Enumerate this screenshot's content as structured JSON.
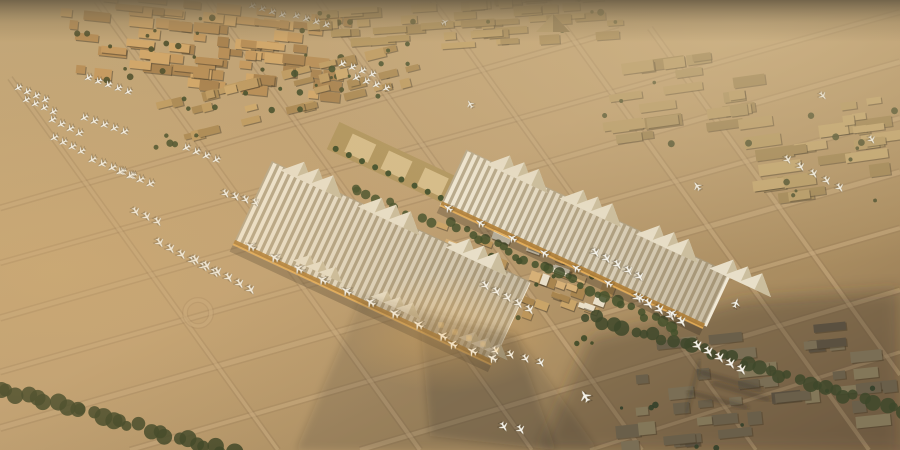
{
  "meta": {
    "title": "Aerial rendering of a desert mega-airport at golden hour",
    "description": "Computer-generated aerial view: striped white terminal canopies with triangular peaks, a low-rise medina-style core, taxiway grids with rows of parked aircraft, warehouse districts on the horizon, tree lines and long evening shadows over sand."
  },
  "palette": {
    "sand_light": "#c8ab7c",
    "sand_mid": "#b99a6c",
    "sand_dark": "#8a7253",
    "horizon": "#6f6148",
    "haze": "#d6bf93",
    "taxiway_light": "#d2b486",
    "taxiway_dark": "#8a7050",
    "canopy_stripe": "#f1e9d6",
    "canopy_base": "#b7a98c",
    "facade_gold": "#c28a3e",
    "glow": "#f2b761",
    "building_tan": "#c59a60",
    "building_shadowed": "#6a5f4a",
    "vegetation": "#44512c",
    "aircraft": "#f4f2ea",
    "shadow": "#322c21"
  },
  "scene": {
    "taxiway_lines": [
      {
        "x1": 0,
        "y1": 208,
        "x2": 620,
        "y2": 30,
        "w": 4
      },
      {
        "x1": 0,
        "y1": 263,
        "x2": 900,
        "y2": 12,
        "w": 3.5
      },
      {
        "x1": 0,
        "y1": 318,
        "x2": 900,
        "y2": 62,
        "w": 4.5
      },
      {
        "x1": 0,
        "y1": 372,
        "x2": 900,
        "y2": 118,
        "w": 4
      },
      {
        "x1": 0,
        "y1": 428,
        "x2": 900,
        "y2": 172,
        "w": 5
      },
      {
        "x1": 130,
        "y1": 450,
        "x2": 900,
        "y2": 228,
        "w": 4
      },
      {
        "x1": 360,
        "y1": 450,
        "x2": 900,
        "y2": 290,
        "w": 4.5
      },
      {
        "x1": 590,
        "y1": 450,
        "x2": 900,
        "y2": 352,
        "w": 3.5
      },
      {
        "x1": 96,
        "y1": 0,
        "x2": 420,
        "y2": 450,
        "w": 4
      },
      {
        "x1": 208,
        "y1": 0,
        "x2": 532,
        "y2": 450,
        "w": 3.5
      },
      {
        "x1": 318,
        "y1": 0,
        "x2": 642,
        "y2": 450,
        "w": 4
      },
      {
        "x1": 432,
        "y1": 0,
        "x2": 756,
        "y2": 450,
        "w": 3.5
      },
      {
        "x1": 545,
        "y1": 0,
        "x2": 869,
        "y2": 450,
        "w": 4
      },
      {
        "x1": 10,
        "y1": 78,
        "x2": 278,
        "y2": 450,
        "w": 3.5
      },
      {
        "x1": 650,
        "y1": 28,
        "x2": 900,
        "y2": 375,
        "w": 4
      }
    ],
    "roundabout": {
      "x": 198,
      "y": 313,
      "r": 13
    },
    "shade_southeast": {
      "pts": "540,450 900,450 900,290 745,300 590,338",
      "fill": "#3a3226",
      "op": 0.34
    },
    "clusters": [
      {
        "name": "city-top-left",
        "cx": 205,
        "cy": 48,
        "w": 300,
        "h": 94,
        "rot": 6,
        "n": 95,
        "rowH": 11,
        "bw": [
          8,
          30
        ],
        "bh": [
          6,
          11
        ],
        "cols": [
          "#c59a60",
          "#b88f58",
          "#d1a76a",
          "#a98350"
        ],
        "green": 26,
        "gcol": "#4f512e",
        "seed": 7
      },
      {
        "name": "city-top-strip",
        "cx": 465,
        "cy": 26,
        "w": 330,
        "h": 52,
        "rot": -4,
        "n": 55,
        "rowH": 10,
        "bw": [
          10,
          34
        ],
        "bh": [
          5,
          10
        ],
        "cols": [
          "#b3955f",
          "#a78a58",
          "#c0a068"
        ],
        "green": 10,
        "gcol": "#4f512e",
        "seed": 11
      },
      {
        "name": "warehouses-right-a",
        "cx": 685,
        "cy": 100,
        "w": 170,
        "h": 90,
        "rot": -8,
        "n": 26,
        "rowH": 14,
        "bw": [
          14,
          40
        ],
        "bh": [
          7,
          12
        ],
        "cols": [
          "#ab9263",
          "#b89c6a",
          "#9c8356"
        ],
        "green": 4,
        "gcol": "#4a4f2e",
        "seed": 3
      },
      {
        "name": "warehouses-right-b",
        "cx": 825,
        "cy": 160,
        "w": 160,
        "h": 100,
        "rot": -8,
        "n": 24,
        "rowH": 15,
        "bw": [
          14,
          44
        ],
        "bh": [
          8,
          13
        ],
        "cols": [
          "#b59a66",
          "#c2a671",
          "#a08656"
        ],
        "green": 8,
        "gcol": "#4a4f2e",
        "seed": 5
      },
      {
        "name": "development-strip",
        "cx": 285,
        "cy": 95,
        "w": 280,
        "h": 48,
        "rot": -14,
        "n": 40,
        "rowH": 12,
        "bw": [
          8,
          22
        ],
        "bh": [
          5,
          10
        ],
        "cols": [
          "#bf9c63",
          "#cda96e",
          "#ab8a55"
        ],
        "green": 22,
        "gcol": "#46502c",
        "seed": 13
      },
      {
        "name": "far-right-cluster",
        "cx": 872,
        "cy": 125,
        "w": 60,
        "h": 55,
        "rot": -8,
        "n": 10,
        "rowH": 13,
        "bw": [
          10,
          26
        ],
        "bh": [
          6,
          11
        ],
        "cols": [
          "#b59a66",
          "#c2a671",
          "#a08656"
        ],
        "green": 3,
        "gcol": "#4a4f2e",
        "seed": 29
      },
      {
        "name": "terminal-medina-core",
        "cx": 520,
        "cy": 268,
        "w": 200,
        "h": 110,
        "rot": 20,
        "n": 72,
        "rowH": 13,
        "bw": [
          7,
          20
        ],
        "bh": [
          5,
          12
        ],
        "cols": [
          "#c9a468",
          "#b8935a",
          "#d6b077",
          "#a8854f",
          "#e9dfc8"
        ],
        "green": 18,
        "gcol": "#3f4a28",
        "seed": 17
      },
      {
        "name": "city-bottom-right-shadowed",
        "cx": 760,
        "cy": 392,
        "w": 300,
        "h": 125,
        "rot": -6,
        "n": 46,
        "rowH": 16,
        "bw": [
          12,
          36
        ],
        "bh": [
          7,
          13
        ],
        "cols": [
          "#6a5f4a",
          "#7a6e55",
          "#5a5040",
          "#837759"
        ],
        "green": 10,
        "gcol": "#33402a",
        "seed": 23
      }
    ],
    "pyramid": {
      "pts": "536,32 570,32 553,14",
      "fill": "#b59a68",
      "shade": "553,14 570,32 553,32",
      "shadefill": "#8a744c"
    },
    "tree_lines": [
      {
        "x1": 0,
        "y1": 388,
        "x2": 232,
        "y2": 452,
        "n": 26,
        "rmin": 5,
        "rmax": 9,
        "col": "#3c4426",
        "seed": 31
      },
      {
        "x1": 585,
        "y1": 315,
        "x2": 905,
        "y2": 412,
        "n": 34,
        "rmin": 4,
        "rmax": 8,
        "col": "#3e482a",
        "seed": 37
      },
      {
        "x1": 448,
        "y1": 222,
        "x2": 678,
        "y2": 330,
        "n": 30,
        "rmin": 3,
        "rmax": 6,
        "col": "#44512c",
        "seed": 41
      },
      {
        "x1": 352,
        "y1": 190,
        "x2": 430,
        "y2": 222,
        "n": 10,
        "rmin": 3,
        "rmax": 5,
        "col": "#46522d",
        "seed": 43
      }
    ],
    "park": {
      "cx": 392,
      "cy": 163,
      "len": 130,
      "wid": 30,
      "rot": 25,
      "base": "#b1965f",
      "pools": "#d6bd8a",
      "green": "#42502b"
    },
    "canopies": [
      {
        "name": "concourse-canopy-east",
        "cx": 585,
        "cy": 238,
        "len": 290,
        "wid": 58,
        "rot": 25,
        "stripe": 7,
        "base": "#b7a98c",
        "stripecol": "#f1e9d6",
        "peak": "#e8dfc9",
        "peakShade": "#c6b897",
        "facade": "#b07e36",
        "glow": "#e8ae55",
        "peaks": [
          -0.3,
          -0.02,
          0.27,
          0.55
        ],
        "midpeaks": []
      },
      {
        "name": "main-terminal-canopy",
        "cx": 382,
        "cy": 262,
        "len": 285,
        "wid": 88,
        "rot": 25,
        "stripe": 7,
        "base": "#b7a98c",
        "stripecol": "#f1e9d6",
        "peak": "#e8dfc9",
        "peakShade": "#c6b897",
        "facade": "#b07e36",
        "glow": "#e8ae55",
        "peaks": [
          -0.34,
          -0.04,
          0.3
        ],
        "midpeaks": [
          -0.19,
          0.11,
          0.45
        ]
      }
    ],
    "terminal_shadows": [
      {
        "pts": "362,296 515,332 598,450 296,450",
        "fill": "#322c21",
        "op": 0.17
      },
      {
        "pts": "420,318 516,338 556,450 430,436",
        "fill": "#2c261d",
        "op": 0.2
      }
    ],
    "shadow_streaks": [
      {
        "x1": 700,
        "y1": 372,
        "x2": 762,
        "y2": 390,
        "w": 3
      },
      {
        "x1": 712,
        "y1": 383,
        "x2": 770,
        "y2": 400,
        "w": 3
      },
      {
        "x1": 688,
        "y1": 392,
        "x2": 748,
        "y2": 408,
        "w": 3
      },
      {
        "x1": 700,
        "y1": 360,
        "x2": 686,
        "y2": 414,
        "w": 2
      }
    ],
    "plane_rows": [
      {
        "x": 18,
        "y": 88,
        "n": 4,
        "dx": 9,
        "dy": 4,
        "rot": -120,
        "s": 0.8
      },
      {
        "x": 26,
        "y": 100,
        "n": 4,
        "dx": 9,
        "dy": 4,
        "rot": -120,
        "s": 0.8
      },
      {
        "x": 52,
        "y": 120,
        "n": 4,
        "dx": 9,
        "dy": 4.5,
        "rot": -120,
        "s": 0.85
      },
      {
        "x": 54,
        "y": 138,
        "n": 4,
        "dx": 9,
        "dy": 4.5,
        "rot": -120,
        "s": 0.85
      },
      {
        "x": 88,
        "y": 78,
        "n": 5,
        "dx": 10,
        "dy": 3.5,
        "rot": -120,
        "s": 0.8
      },
      {
        "x": 84,
        "y": 118,
        "n": 5,
        "dx": 10,
        "dy": 3.5,
        "rot": -120,
        "s": 0.85
      },
      {
        "x": 92,
        "y": 160,
        "n": 5,
        "dx": 10,
        "dy": 4,
        "rot": -120,
        "s": 0.9
      },
      {
        "x": 120,
        "y": 172,
        "n": 4,
        "dx": 10,
        "dy": 4,
        "rot": -120,
        "s": 0.9
      },
      {
        "x": 186,
        "y": 148,
        "n": 4,
        "dx": 10,
        "dy": 4,
        "rot": -120,
        "s": 0.85
      },
      {
        "x": 252,
        "y": 6,
        "n": 4,
        "dx": 10,
        "dy": 3,
        "rot": -120,
        "s": 0.75
      },
      {
        "x": 296,
        "y": 16,
        "n": 4,
        "dx": 10,
        "dy": 3,
        "rot": -120,
        "s": 0.75
      },
      {
        "x": 342,
        "y": 64,
        "n": 4,
        "dx": 10,
        "dy": 3.5,
        "rot": -120,
        "s": 0.8
      },
      {
        "x": 356,
        "y": 78,
        "n": 4,
        "dx": 10,
        "dy": 3.5,
        "rot": -120,
        "s": 0.8
      },
      {
        "x": 136,
        "y": 212,
        "n": 3,
        "dx": 11,
        "dy": 5,
        "rot": 150,
        "s": 0.95
      },
      {
        "x": 160,
        "y": 243,
        "n": 6,
        "dx": 11,
        "dy": 6,
        "rot": 150,
        "s": 1
      },
      {
        "x": 196,
        "y": 260,
        "n": 6,
        "dx": 11,
        "dy": 6,
        "rot": 150,
        "s": 1
      },
      {
        "x": 226,
        "y": 194,
        "n": 4,
        "dx": 10,
        "dy": 3,
        "rot": 150,
        "s": 0.9
      },
      {
        "x": 486,
        "y": 286,
        "n": 5,
        "dx": 11,
        "dy": 6,
        "rot": 150,
        "s": 1
      },
      {
        "x": 596,
        "y": 253,
        "n": 5,
        "dx": 11,
        "dy": 6,
        "rot": 150,
        "s": 1
      },
      {
        "x": 638,
        "y": 298,
        "n": 5,
        "dx": 11,
        "dy": 6,
        "rot": 150,
        "s": 1.05
      },
      {
        "x": 698,
        "y": 346,
        "n": 5,
        "dx": 11,
        "dy": 6,
        "rot": 150,
        "s": 1.05
      },
      {
        "x": 788,
        "y": 160,
        "n": 5,
        "dx": 13,
        "dy": 7,
        "rot": 150,
        "s": 0.9
      },
      {
        "x": 496,
        "y": 351,
        "n": 4,
        "dx": 15,
        "dy": 4,
        "rot": 150,
        "s": 0.9
      },
      {
        "x": 504,
        "y": 427,
        "n": 2,
        "dx": 17,
        "dy": 3,
        "rot": 150,
        "s": 0.95
      },
      {
        "x": 250,
        "y": 246,
        "n": 9,
        "dx": 24,
        "dy": 11.2,
        "rot": -55,
        "s": 1.05
      },
      {
        "x": 448,
        "y": 208,
        "n": 8,
        "dx": 32,
        "dy": 15,
        "rot": -55,
        "s": 0.9
      },
      {
        "x": 452,
        "y": 344,
        "n": 3,
        "dx": 20,
        "dy": 7,
        "rot": -60,
        "s": 1
      }
    ],
    "single_planes": [
      {
        "x": 697,
        "y": 186,
        "rot": -35,
        "s": 0.9
      },
      {
        "x": 823,
        "y": 96,
        "rot": 140,
        "s": 0.85
      },
      {
        "x": 585,
        "y": 396,
        "rot": -30,
        "s": 1.15
      },
      {
        "x": 470,
        "y": 104,
        "rot": -30,
        "s": 0.8
      },
      {
        "x": 736,
        "y": 303,
        "rot": 20,
        "s": 0.9
      },
      {
        "x": 445,
        "y": 22,
        "rot": 60,
        "s": 0.7
      },
      {
        "x": 872,
        "y": 140,
        "rot": 150,
        "s": 0.85
      }
    ],
    "facade_glints": [
      {
        "x": 441,
        "y": 325,
        "r": 2.2
      },
      {
        "x": 455,
        "y": 332,
        "r": 2.2
      },
      {
        "x": 469,
        "y": 338,
        "r": 2.4
      },
      {
        "x": 483,
        "y": 344,
        "r": 2.2
      },
      {
        "x": 497,
        "y": 350,
        "r": 2
      }
    ]
  }
}
